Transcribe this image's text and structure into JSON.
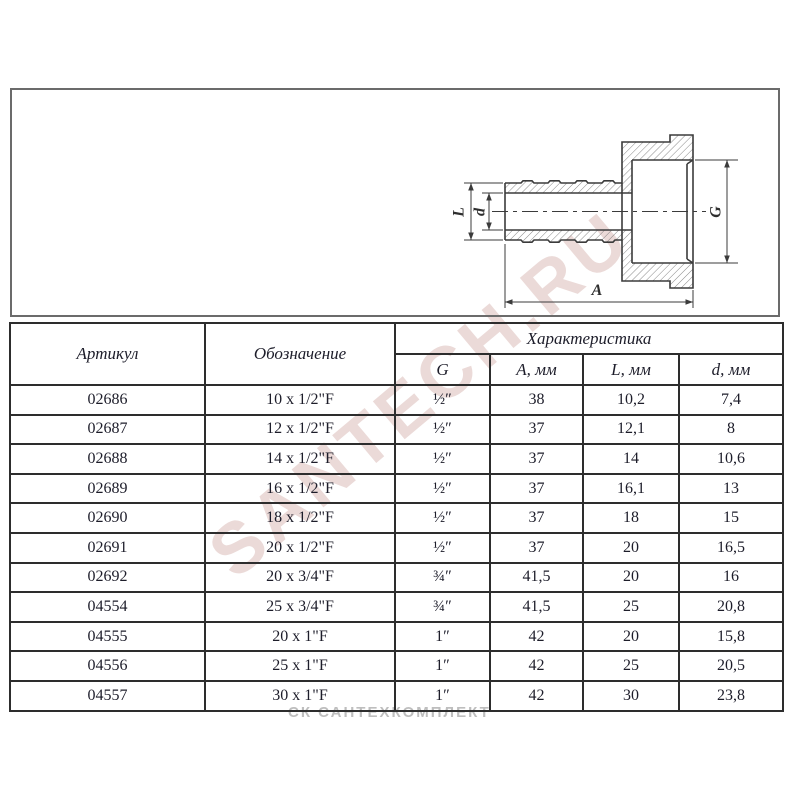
{
  "watermarks": {
    "diagonal": "SANTECH.RU",
    "footer": "СК САНТЕХКОМПЛЕКТ"
  },
  "drawing": {
    "labels": {
      "L": "L",
      "d": "d",
      "G": "G",
      "A": "A"
    }
  },
  "table": {
    "header_article": "Артикул",
    "header_designation": "Обозначение",
    "header_characteristic": "Характеристика",
    "sub_headers": [
      "G",
      "A, мм",
      "L, мм",
      "d, мм"
    ],
    "column_keys": [
      "article",
      "designation",
      "g_inch",
      "a_mm",
      "l_mm",
      "d_mm"
    ],
    "rows": [
      [
        "02686",
        "10 x 1/2\"F",
        "½″",
        "38",
        "10,2",
        "7,4"
      ],
      [
        "02687",
        "12 x 1/2\"F",
        "½″",
        "37",
        "12,1",
        "8"
      ],
      [
        "02688",
        "14 x 1/2\"F",
        "½″",
        "37",
        "14",
        "10,6"
      ],
      [
        "02689",
        "16 x 1/2\"F",
        "½″",
        "37",
        "16,1",
        "13"
      ],
      [
        "02690",
        "18 x 1/2\"F",
        "½″",
        "37",
        "18",
        "15"
      ],
      [
        "02691",
        "20 x 1/2\"F",
        "½″",
        "37",
        "20",
        "16,5"
      ],
      [
        "02692",
        "20 x 3/4\"F",
        "¾″",
        "41,5",
        "20",
        "16"
      ],
      [
        "04554",
        "25 x 3/4\"F",
        "¾″",
        "41,5",
        "25",
        "20,8"
      ],
      [
        "04555",
        "20 x 1\"F",
        "1″",
        "42",
        "20",
        "15,8"
      ],
      [
        "04556",
        "25 x 1\"F",
        "1″",
        "42",
        "25",
        "20,5"
      ],
      [
        "04557",
        "30 x 1\"F",
        "1″",
        "42",
        "30",
        "23,8"
      ]
    ]
  }
}
